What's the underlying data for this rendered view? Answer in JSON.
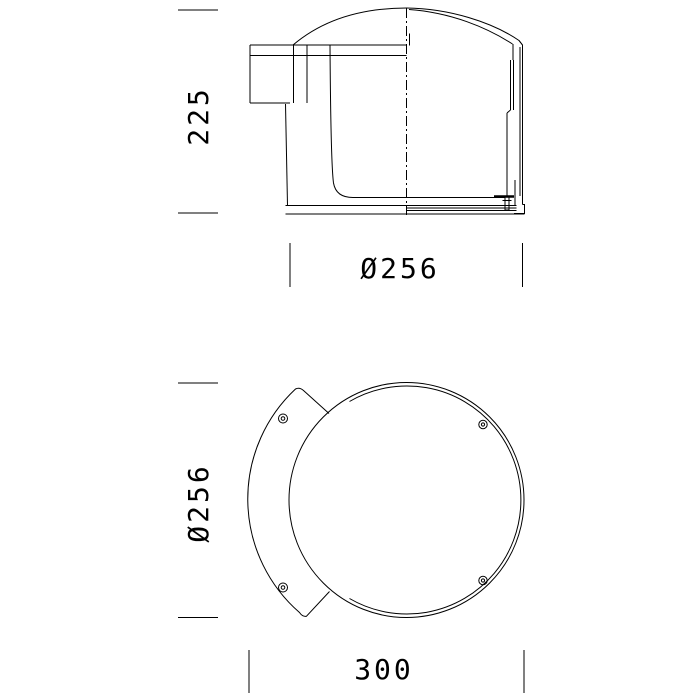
{
  "page": {
    "background_color": "#ffffff",
    "line_color": "#000000",
    "content_type": "technical-drawing"
  },
  "drawing": {
    "subject": "round wall-mounted luminaire, two orthographic views",
    "views": {
      "side": {
        "label": "side-elevation",
        "features": [
          "dome-top",
          "wall-mount-plate",
          "bracket-arm",
          "housing-body",
          "base-plate",
          "latch-screw",
          "center-axis-line"
        ],
        "dimensions": {
          "height": "225",
          "diameter": "Ø256"
        }
      },
      "front": {
        "label": "front-view",
        "features": [
          "round-bezel",
          "crescent-mounting-bracket",
          "bracket-screws",
          "rim-screws"
        ],
        "dimensions": {
          "diameter": "Ø256",
          "width": "300"
        }
      }
    }
  }
}
